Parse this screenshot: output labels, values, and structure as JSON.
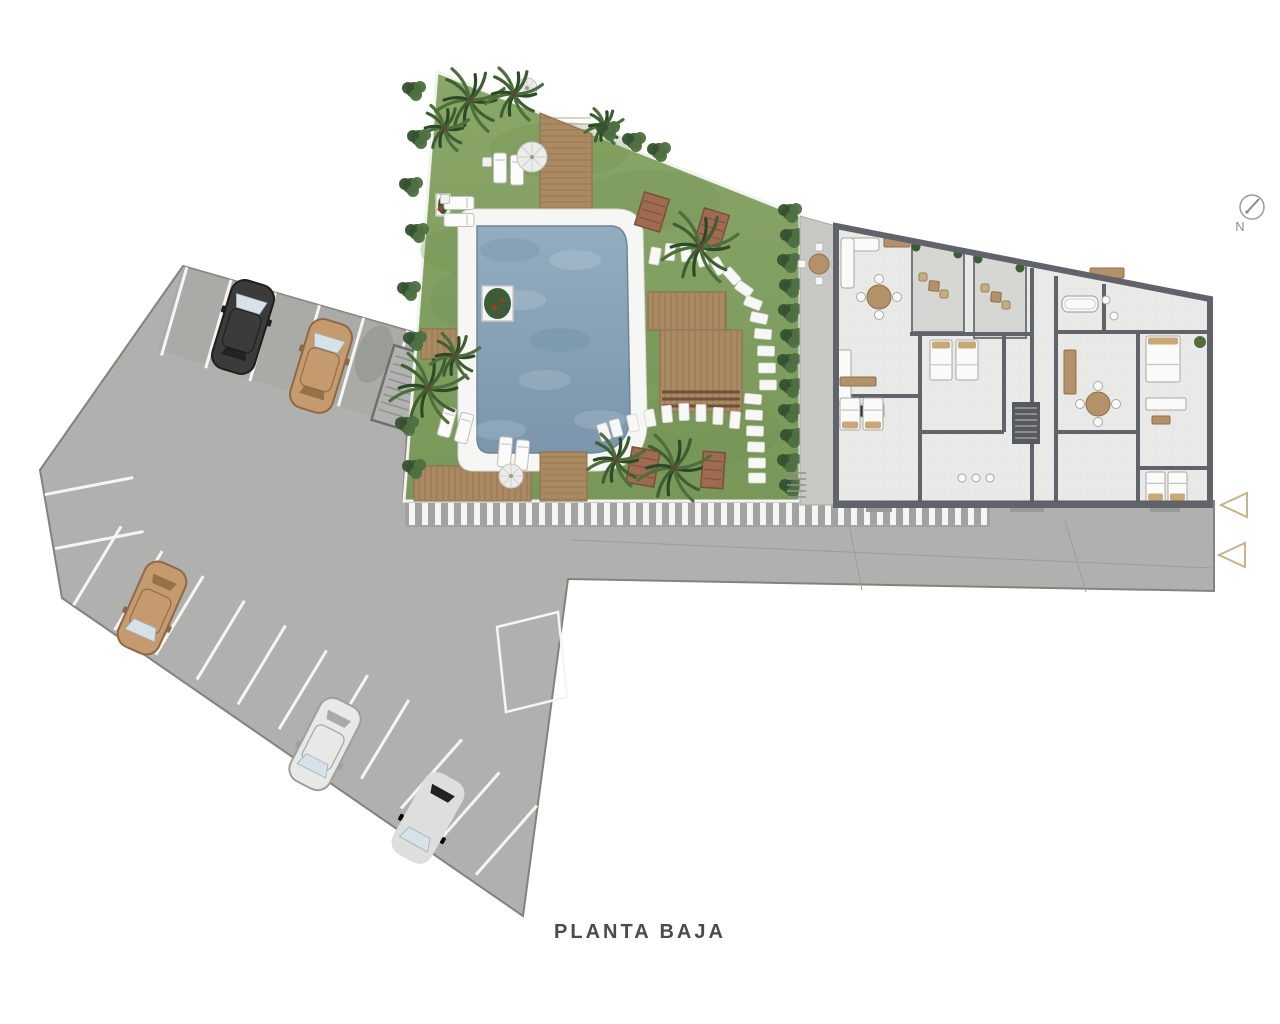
{
  "meta": {
    "title": "PLANTA BAJA",
    "north_label": "N"
  },
  "palette": {
    "paved": "#b0b0ae",
    "paved_dark": "#a5a5a3",
    "paved_edge": "#82827f",
    "line_white": "#f5f5f3",
    "road_joint": "#9c9c9a",
    "grass_light": "#88a566",
    "grass_dark": "#78975a",
    "grass_shade": "#6f8f50",
    "wood": "#ab8a63",
    "wood_line": "#8a6c4c",
    "wood_dark": "#9e7e58",
    "bench": "#9e6b51",
    "bench_edge": "#7c4f3a",
    "pool_rim": "#f6f6f4",
    "water_light": "#92adc0",
    "water_dark": "#7b96ac",
    "water_edge": "#6e8599",
    "palm_dark": "#2d4a27",
    "palm_mid": "#3f5f33",
    "palm_light": "#4c6f3c",
    "trunk": "#5d4a33",
    "bush_a": "#3e5c36",
    "bush_b": "#4e7041",
    "bush_c": "#365230",
    "patio": "#c8c8c5",
    "terrace": "#d6d6d3",
    "floor": "#e9e9e7",
    "tile_line": "#dfdfdc",
    "wall": "#60646a",
    "furn_white": "#fafaf8",
    "furn_stroke": "#a8a8a6",
    "furn_wood": "#b3926a",
    "pillow": "#c9a876",
    "dark_appliance": "#2f2f2f",
    "stair": "#56595d",
    "stair_tread": "#9b9ea2",
    "arrow": "#c8b488",
    "north": "#9b9b99",
    "glass": "#d6e2e8",
    "umbrella": "#ececea"
  },
  "paved": {
    "outline": [
      [
        183,
        266
      ],
      [
        413,
        332
      ],
      [
        403,
        501
      ],
      [
        1214,
        501
      ],
      [
        1214,
        591
      ],
      [
        568,
        579
      ],
      [
        523,
        916
      ],
      [
        62,
        598
      ],
      [
        40,
        470
      ]
    ],
    "top_shade": [
      [
        183,
        266
      ],
      [
        413,
        332
      ],
      [
        408,
        428
      ],
      [
        158,
        350
      ]
    ],
    "joints": [
      [
        572,
        540,
        1212,
        568
      ],
      [
        845,
        504,
        862,
        590
      ],
      [
        1065,
        520,
        1086,
        592
      ]
    ],
    "shadow": {
      "x": 374,
      "y": 354,
      "rx": 17,
      "ry": 30,
      "rot": 20
    }
  },
  "walkway": {
    "x1": 405,
    "x2": 990,
    "y": 501,
    "h": 26,
    "stripe_w": 6,
    "step": 13
  },
  "parking": {
    "rows": [
      {
        "edge": [
          [
            183,
            266
          ],
          [
            413,
            332
          ]
        ],
        "offsets": [
          4,
          50,
          96,
          142,
          188,
          234
        ],
        "len": 92,
        "side": 1
      },
      {
        "edge": [
          [
            40,
            470
          ],
          [
            65,
            600
          ]
        ],
        "offsets": [
          25,
          80
        ],
        "len": 90,
        "side": -1
      },
      {
        "edge": [
          [
            65,
            600
          ],
          [
            380,
            790
          ]
        ],
        "offsets": [
          10,
          58,
          106,
          154,
          202,
          250,
          298,
          346
        ],
        "len": 92,
        "side": -1
      },
      {
        "edge": [
          [
            380,
            790
          ],
          [
            523,
            916
          ]
        ],
        "offsets": [
          28,
          78,
          128
        ],
        "len": 92,
        "side": -1
      }
    ],
    "marked_spot": [
      [
        497,
        627
      ],
      [
        558,
        612
      ],
      [
        567,
        697
      ],
      [
        506,
        712
      ]
    ],
    "ramp": {
      "x": 401,
      "y": 388,
      "w": 38,
      "h": 78,
      "rot": 17
    },
    "cars": [
      {
        "name": "car-black",
        "x": 243,
        "y": 327,
        "rot": 17,
        "body": "#3b3b3b",
        "dark": "#1f1f1f",
        "front": "up"
      },
      {
        "name": "car-tan-top",
        "x": 321,
        "y": 366,
        "rot": 17,
        "body": "#c59a6e",
        "dark": "#8d6a43",
        "front": "up"
      },
      {
        "name": "car-tan-left",
        "x": 152,
        "y": 608,
        "rot": 24,
        "body": "#c59a6e",
        "dark": "#8d6a43",
        "front": "down"
      },
      {
        "name": "car-white",
        "x": 325,
        "y": 744,
        "rot": 27,
        "body": "#e8e8e6",
        "dark": "#9f9f9d",
        "front": "down"
      },
      {
        "name": "car-silver",
        "x": 428,
        "y": 818,
        "rot": 29,
        "body": "#dededc",
        "dark": "#98989 6",
        "front": "down"
      }
    ]
  },
  "garden": {
    "outline": [
      [
        437,
        72
      ],
      [
        800,
        216
      ],
      [
        800,
        501
      ],
      [
        404,
        501
      ]
    ],
    "shade": [
      [
        520,
        300,
        90,
        40
      ],
      [
        650,
        200,
        70,
        30
      ],
      [
        700,
        430,
        80,
        36
      ],
      [
        480,
        250,
        60,
        26
      ],
      [
        600,
        350,
        100,
        40
      ],
      [
        560,
        150,
        70,
        28
      ]
    ],
    "decks": [
      {
        "name": "deck-top",
        "pts": [
          [
            540,
            113
          ],
          [
            592,
            134
          ],
          [
            592,
            211
          ],
          [
            540,
            211
          ]
        ],
        "dir": "h"
      },
      {
        "name": "deck-left",
        "pts": [
          [
            421,
            329
          ],
          [
            533,
            329
          ],
          [
            533,
            359
          ],
          [
            421,
            359
          ]
        ],
        "dir": "v"
      },
      {
        "name": "deck-lower-left",
        "pts": [
          [
            414,
            466
          ],
          [
            531,
            466
          ],
          [
            531,
            501
          ],
          [
            414,
            501
          ]
        ],
        "dir": "v"
      },
      {
        "name": "deck-below-pool",
        "pts": [
          [
            540,
            452
          ],
          [
            587,
            452
          ],
          [
            587,
            501
          ],
          [
            540,
            501
          ]
        ],
        "dir": "h"
      },
      {
        "name": "deck-platform-1",
        "pts": [
          [
            648,
            292
          ],
          [
            726,
            292
          ],
          [
            726,
            330
          ],
          [
            648,
            330
          ]
        ],
        "dir": "v"
      },
      {
        "name": "deck-platform-2",
        "pts": [
          [
            660,
            330
          ],
          [
            742,
            330
          ],
          [
            742,
            412
          ],
          [
            660,
            412
          ]
        ],
        "dir": "v",
        "slats": true
      }
    ],
    "pool": {
      "rim": "M458,224 Q458,209 474,209 L616,209 Q640,209 643,231 L647,415 Q650,468 598,471 L474,471 Q458,471 458,455 Z",
      "water": "M477,226 L612,226 Q626,227 627,246 L630,412 Q631,452 590,453 L490,453 Q477,453 477,438 Z"
    },
    "planter": {
      "x": 482,
      "y": 286,
      "w": 31,
      "h": 35
    },
    "planter2": {
      "x": 436,
      "y": 194,
      "w": 14,
      "h": 22
    },
    "benches": [
      [
        652,
        212,
        26,
        34,
        17
      ],
      [
        712,
        228,
        26,
        34,
        17
      ],
      [
        643,
        467,
        28,
        36,
        10
      ],
      [
        713,
        470,
        22,
        36,
        4
      ]
    ],
    "stones": [
      [
        655,
        256,
        100
      ],
      [
        670,
        252,
        95
      ],
      [
        686,
        253,
        85
      ],
      [
        702,
        258,
        75
      ],
      [
        718,
        266,
        60
      ],
      [
        732,
        276,
        48
      ],
      [
        744,
        289,
        35
      ],
      [
        753,
        303,
        22
      ],
      [
        759,
        318,
        12
      ],
      [
        763,
        334,
        5
      ],
      [
        766,
        351,
        2
      ],
      [
        767,
        368,
        0
      ],
      [
        768,
        385,
        0
      ],
      [
        753,
        399,
        5
      ],
      [
        754,
        415,
        3
      ],
      [
        755,
        431,
        2
      ],
      [
        756,
        447,
        2
      ],
      [
        757,
        463,
        1
      ],
      [
        757,
        478,
        0
      ],
      [
        735,
        420,
        95
      ],
      [
        718,
        416,
        92
      ],
      [
        701,
        413,
        90
      ],
      [
        684,
        412,
        88
      ],
      [
        667,
        414,
        85
      ],
      [
        650,
        418,
        80
      ],
      [
        633,
        423,
        78
      ],
      [
        616,
        428,
        75
      ],
      [
        604,
        432,
        72
      ]
    ],
    "loungers": [
      [
        500,
        168,
        0
      ],
      [
        517,
        170,
        0
      ],
      [
        459,
        203,
        90
      ],
      [
        459,
        220,
        90
      ],
      [
        447,
        422,
        15
      ],
      [
        464,
        428,
        15
      ],
      [
        505,
        452,
        5
      ],
      [
        522,
        455,
        5
      ]
    ],
    "side_tables": [
      [
        487,
        162,
        9
      ],
      [
        445,
        199,
        9
      ]
    ],
    "umbrellas": [
      [
        532,
        157,
        15
      ],
      [
        511,
        476,
        12
      ],
      [
        527,
        88,
        10
      ]
    ],
    "palms": [
      [
        470,
        100,
        36
      ],
      [
        514,
        94,
        30
      ],
      [
        444,
        128,
        26
      ],
      [
        604,
        126,
        20
      ],
      [
        428,
        388,
        40
      ],
      [
        455,
        356,
        26
      ],
      [
        700,
        247,
        40
      ],
      [
        616,
        460,
        30
      ],
      [
        674,
        468,
        38
      ]
    ],
    "bushes": [
      [
        414,
        90
      ],
      [
        419,
        138
      ],
      [
        411,
        186
      ],
      [
        417,
        232
      ],
      [
        409,
        290
      ],
      [
        415,
        340
      ],
      [
        407,
        425
      ],
      [
        414,
        468
      ],
      [
        608,
        130
      ],
      [
        634,
        141
      ],
      [
        659,
        151
      ],
      [
        790,
        212
      ],
      [
        792,
        237
      ],
      [
        789,
        262
      ],
      [
        791,
        287
      ],
      [
        790,
        312
      ],
      [
        792,
        337
      ],
      [
        789,
        362
      ],
      [
        791,
        387
      ],
      [
        790,
        412
      ],
      [
        792,
        437
      ],
      [
        789,
        462
      ],
      [
        791,
        487
      ]
    ]
  },
  "patio": {
    "outline": [
      [
        800,
        216
      ],
      [
        836,
        226
      ],
      [
        836,
        505
      ],
      [
        800,
        505
      ]
    ],
    "steps": {
      "x": 787,
      "y": 473,
      "w": 19,
      "n": 5,
      "dy": 6
    },
    "table": {
      "x": 819,
      "y": 264,
      "r": 10
    }
  },
  "building": {
    "outline": [
      [
        836,
        226
      ],
      [
        1210,
        299
      ],
      [
        1210,
        505
      ],
      [
        836,
        505
      ]
    ],
    "terraces": [
      {
        "pts": [
          [
            912,
            241
          ],
          [
            964,
            251
          ],
          [
            964,
            332
          ],
          [
            912,
            332
          ]
        ],
        "table": [
          934,
          286
        ],
        "shrubs": [
          [
            916,
            247
          ],
          [
            958,
            254
          ]
        ]
      },
      {
        "pts": [
          [
            974,
            253
          ],
          [
            1026,
            263
          ],
          [
            1026,
            338
          ],
          [
            974,
            338
          ]
        ],
        "table": [
          996,
          297
        ],
        "shrubs": [
          [
            978,
            259
          ],
          [
            1020,
            268
          ]
        ]
      }
    ],
    "walls": [
      [
        836,
        396,
        920,
        396
      ],
      [
        920,
        334,
        920,
        505
      ],
      [
        920,
        432,
        1004,
        432
      ],
      [
        1004,
        334,
        1004,
        432
      ],
      [
        910,
        334,
        1032,
        334
      ],
      [
        1032,
        268,
        1032,
        505
      ],
      [
        1056,
        276,
        1056,
        505
      ],
      [
        1056,
        332,
        1210,
        332
      ],
      [
        1104,
        284,
        1104,
        332
      ],
      [
        1138,
        332,
        1138,
        505
      ],
      [
        1138,
        468,
        1210,
        468
      ],
      [
        1056,
        432,
        1138,
        432
      ]
    ],
    "stair": {
      "x": 1012,
      "y": 402,
      "w": 28,
      "h": 42
    },
    "steps_below": [
      [
        866,
        505,
        26,
        7
      ],
      [
        1010,
        505,
        34,
        7
      ],
      [
        1150,
        505,
        30,
        7
      ]
    ],
    "plant_right": [
      1200,
      342
    ],
    "furniture": [
      {
        "t": "sofaL",
        "x": 841,
        "y": 238
      },
      {
        "t": "rect",
        "x": 884,
        "y": 238,
        "w": 26,
        "h": 9,
        "f": "wood",
        "n": "tv-bench"
      },
      {
        "t": "rtable",
        "x": 879,
        "y": 297,
        "r": 12
      },
      {
        "t": "rect",
        "x": 838,
        "y": 350,
        "w": 13,
        "h": 62,
        "f": "white",
        "n": "kitchen-counter"
      },
      {
        "t": "rect",
        "x": 838,
        "y": 404,
        "w": 46,
        "h": 13,
        "f": "white",
        "n": "kitchen-counter"
      },
      {
        "t": "rect",
        "x": 860,
        "y": 406,
        "w": 12,
        "h": 10,
        "f": "dark",
        "n": "stove"
      },
      {
        "t": "rect",
        "x": 840,
        "y": 377,
        "w": 36,
        "h": 9,
        "f": "wood",
        "n": "kitchen-island"
      },
      {
        "t": "bed",
        "x": 840,
        "y": 398,
        "w": 20,
        "h": 32,
        "head": "bottom"
      },
      {
        "t": "bed",
        "x": 863,
        "y": 398,
        "w": 20,
        "h": 32,
        "head": "bottom"
      },
      {
        "t": "bed",
        "x": 930,
        "y": 340,
        "w": 22,
        "h": 40,
        "head": "top"
      },
      {
        "t": "bed",
        "x": 956,
        "y": 340,
        "w": 22,
        "h": 40,
        "head": "top"
      },
      {
        "t": "sink",
        "x": 962,
        "y": 478
      },
      {
        "t": "sink",
        "x": 976,
        "y": 478
      },
      {
        "t": "sink",
        "x": 990,
        "y": 478
      },
      {
        "t": "tub",
        "x": 1062,
        "y": 296,
        "w": 36,
        "h": 16
      },
      {
        "t": "sink",
        "x": 1106,
        "y": 300
      },
      {
        "t": "sink",
        "x": 1114,
        "y": 316
      },
      {
        "t": "bed",
        "x": 1146,
        "y": 336,
        "w": 34,
        "h": 46,
        "head": "top",
        "double": true
      },
      {
        "t": "rtable",
        "x": 1098,
        "y": 404,
        "r": 12
      },
      {
        "t": "rect",
        "x": 1146,
        "y": 398,
        "w": 40,
        "h": 12,
        "f": "white",
        "n": "sofa"
      },
      {
        "t": "rect",
        "x": 1152,
        "y": 416,
        "w": 18,
        "h": 8,
        "f": "wood",
        "n": "coffee-table"
      },
      {
        "t": "bed",
        "x": 1146,
        "y": 472,
        "w": 19,
        "h": 30,
        "head": "bottom"
      },
      {
        "t": "bed",
        "x": 1168,
        "y": 472,
        "w": 19,
        "h": 30,
        "head": "bottom"
      },
      {
        "t": "rect",
        "x": 1064,
        "y": 350,
        "w": 12,
        "h": 44,
        "f": "wood",
        "n": "wardrobe"
      },
      {
        "t": "rect",
        "x": 1090,
        "y": 268,
        "w": 34,
        "h": 10,
        "f": "wood",
        "n": "wardrobe"
      }
    ]
  },
  "arrows": [
    [
      [
        1247,
        493
      ],
      [
        1247,
        517
      ],
      [
        1221,
        505
      ]
    ],
    [
      [
        1245,
        543
      ],
      [
        1245,
        567
      ],
      [
        1219,
        555
      ]
    ]
  ],
  "north": {
    "cx": 1252,
    "cy": 207,
    "r": 12,
    "needle": [
      1259,
      199,
      1247,
      212
    ]
  },
  "title_pos": {
    "x": 640,
    "y": 938
  },
  "north_pos": {
    "x": 1240,
    "y": 231
  }
}
